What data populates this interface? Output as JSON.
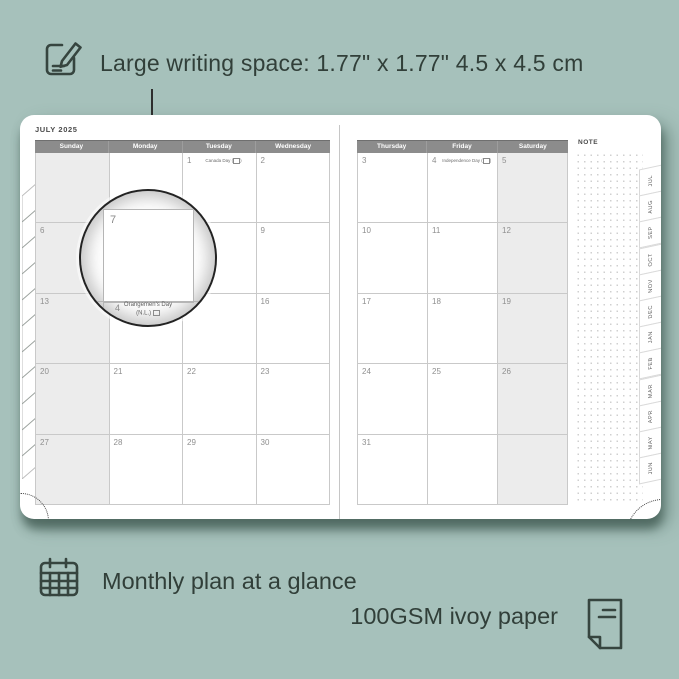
{
  "colors": {
    "background": "#a6c1bb",
    "ink": "#313f39",
    "header_bar": "#8c8c8c",
    "weekend_fill": "#ececec",
    "grid_line": "#c9c9c9"
  },
  "features": {
    "writing_space": "Large writing space: 1.77\" x 1.77\"  4.5 x 4.5 cm",
    "monthly_glance": "Monthly plan at a glance",
    "paper": "100GSM ivoy paper"
  },
  "planner": {
    "month_title": "JULY 2025",
    "note_label": "NOTE",
    "tabs": [
      "JUL",
      "AUG",
      "SEP",
      "OCT",
      "NOV",
      "DEC",
      "JAN",
      "FEB",
      "MAR",
      "APR",
      "MAY",
      "JUN"
    ],
    "left_page": {
      "headers": [
        "Sunday",
        "Monday",
        "Tuesday",
        "Wednesday"
      ],
      "weeks": [
        [
          {
            "d": ""
          },
          {
            "d": ""
          },
          {
            "d": "1",
            "h": "Canada Day",
            "flag": true
          },
          {
            "d": "2"
          }
        ],
        [
          {
            "d": "6"
          },
          {
            "d": "7"
          },
          {
            "d": "8"
          },
          {
            "d": "9"
          }
        ],
        [
          {
            "d": "13"
          },
          {
            "d": "14"
          },
          {
            "d": "15"
          },
          {
            "d": "16"
          }
        ],
        [
          {
            "d": "20"
          },
          {
            "d": "21"
          },
          {
            "d": "22"
          },
          {
            "d": "23"
          }
        ],
        [
          {
            "d": "27"
          },
          {
            "d": "28"
          },
          {
            "d": "29"
          },
          {
            "d": "30"
          }
        ]
      ]
    },
    "right_page": {
      "headers": [
        "Thursday",
        "Friday",
        "Saturday"
      ],
      "weeks": [
        [
          {
            "d": "3"
          },
          {
            "d": "4",
            "h": "Independence Day",
            "flag": true
          },
          {
            "d": "5"
          }
        ],
        [
          {
            "d": "10"
          },
          {
            "d": "11"
          },
          {
            "d": "12"
          }
        ],
        [
          {
            "d": "17"
          },
          {
            "d": "18"
          },
          {
            "d": "19"
          }
        ],
        [
          {
            "d": "24"
          },
          {
            "d": "25"
          },
          {
            "d": "26"
          }
        ],
        [
          {
            "d": "31"
          },
          {
            "d": ""
          },
          {
            "d": ""
          }
        ]
      ]
    },
    "magnifier": {
      "day": "7",
      "next_day": "4",
      "holiday_line1": "Orangemen's Day",
      "holiday_line2": "(N.L.)"
    }
  }
}
